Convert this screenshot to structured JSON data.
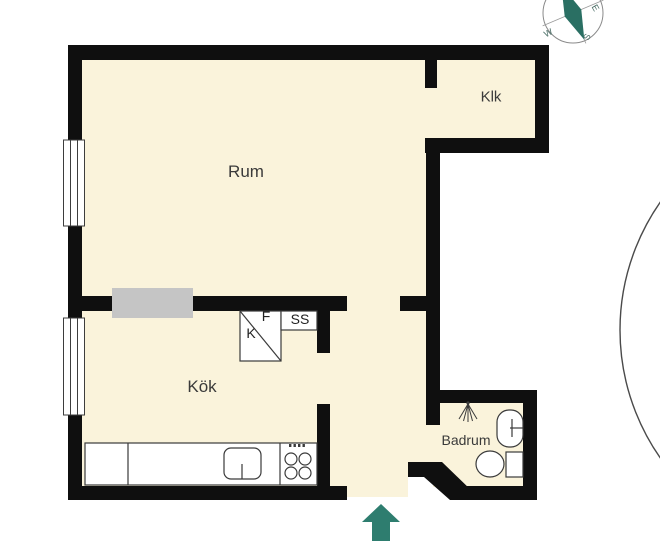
{
  "floorplan": {
    "rooms": {
      "living_room": "Rum",
      "closet": "Klk",
      "kitchen": "Kök",
      "bathroom": "Badrum"
    },
    "kitchen_units": {
      "freezer_label": "F",
      "fridge_label": "K",
      "pantry_label": "SS"
    },
    "compass": {
      "east": "E",
      "west": "W",
      "south": "S"
    },
    "colors": {
      "floor": "#FAF3DB",
      "wall": "#0F0F0F",
      "entrance_arrow": "#2E7D6F",
      "compass_needle": "#2A6F63",
      "wardrobe": "#C5C5C5"
    }
  }
}
